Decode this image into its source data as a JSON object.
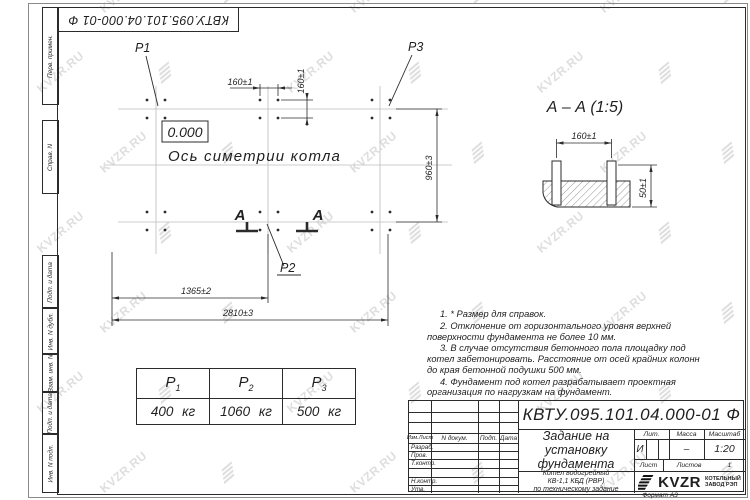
{
  "sheet": {
    "doc_number": "КВТУ.095.101.04.000-01 Ф",
    "format_label": "Формат А3",
    "watermark_text": "KVZR.RU"
  },
  "margin_labels": [
    "Перв. примен.",
    "Справ. N",
    "Подп. и дата",
    "Инв. N дубл.",
    "Взам. инв. N",
    "Подп. и дата",
    "Инв. N подл."
  ],
  "plan": {
    "elevation_mark": "0.000",
    "axis_label": "Ось симетрии котла",
    "point_labels": {
      "p1": "P1",
      "p2": "P2",
      "p3": "P3"
    },
    "section_letter_left": "А",
    "section_letter_right": "А",
    "dims": {
      "bolt_spacing_x": "160±1",
      "bolt_spacing_y": "160±1",
      "width": "960±3",
      "half_length": "1365±2",
      "length": "2810±3"
    }
  },
  "section_view": {
    "title": "А – А (1:5)",
    "dims": {
      "bolt_spacing": "160±1",
      "bolt_height": "50±1"
    }
  },
  "notes": [
    "1. * Размер для справок.",
    "2. Отклонение от горизонтального уровня верхней поверхности фундамента не более 10 мм.",
    "3. В случае отсутствия бетонного пола площадку под котел забетонировать. Расстояние от осей крайних колонн до края бетонной подушки 500 мм.",
    "4. Фундамент под котел разрабатывает проектная организация по нагрузкам на фундамент."
  ],
  "load_table": {
    "headers": [
      {
        "base": "P",
        "sub": "1"
      },
      {
        "base": "P",
        "sub": "2"
      },
      {
        "base": "P",
        "sub": "3"
      }
    ],
    "values": [
      "400 кг",
      "1060 кг",
      "500 кг"
    ]
  },
  "title_block": {
    "doc_number": "КВТУ.095.101.04.000-01 Ф",
    "name_lines": [
      "Задание на",
      "установку",
      "фундамента"
    ],
    "product_lines": [
      "Котел водогрейный",
      "КВ-1,1 КБД (РВР)",
      "по техническому задание"
    ],
    "columns": [
      "Изм.Лист",
      "N докум.",
      "Подп.",
      "Дата"
    ],
    "roles": [
      "Разраб.",
      "Пров.",
      "Т.контр.",
      "",
      "Н.контр.",
      "Утв."
    ],
    "litera_header": "Лит.",
    "mass_header": "Масса",
    "scale_header": "Масштаб",
    "litera_value": "И",
    "mass_value": "–",
    "scale_value": "1:20",
    "sheet_header": "Лист",
    "sheets_header": "Листов",
    "sheets_value": "1",
    "logo": {
      "brand": "KVZR",
      "tagline_lines": [
        "КОТЕЛЬНЫЙ",
        "ЗАВОД РЭП"
      ]
    }
  },
  "colors": {
    "line": "#2b2b2b",
    "faint_axis": "#bcbcbc",
    "watermark": "#c4c4c4",
    "logo": "#111111"
  }
}
